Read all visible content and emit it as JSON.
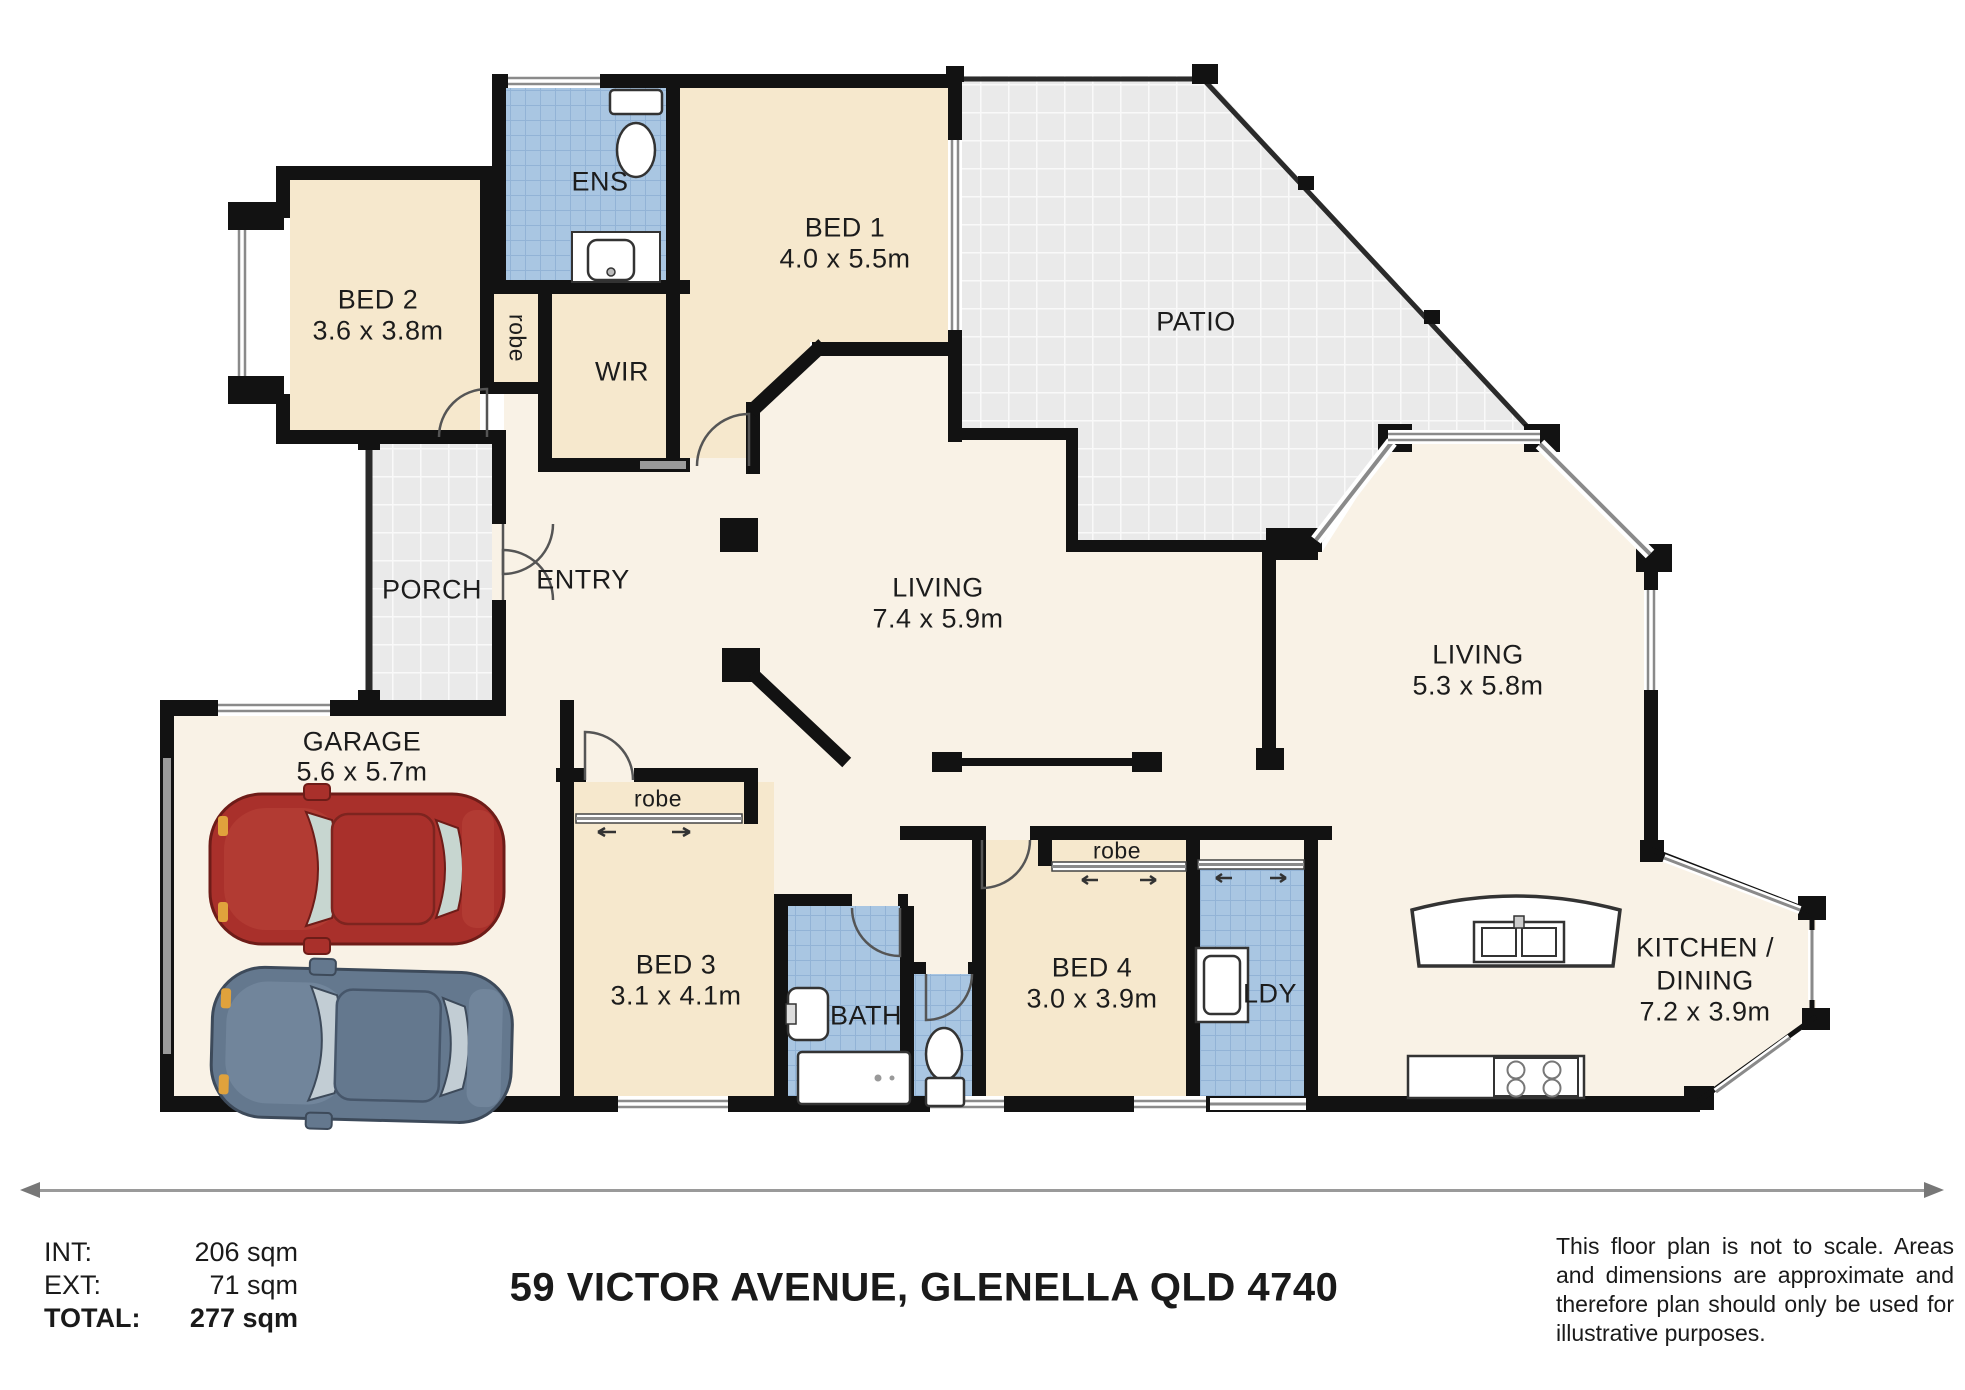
{
  "title": "59 VICTOR AVENUE, GLENELLA QLD 4740",
  "areas": {
    "int_label": "INT:",
    "int_value": "206 sqm",
    "ext_label": "EXT:",
    "ext_value": "71 sqm",
    "total_label": "TOTAL:",
    "total_value": "277 sqm"
  },
  "disclaimer": "This floor plan is not to scale. Areas and dimensions are approximate and therefore plan should only be used for illustrative purposes.",
  "rooms": {
    "ens": {
      "name": "ENS"
    },
    "bed1": {
      "name": "BED 1",
      "dims": "4.0 x 5.5m"
    },
    "bed2": {
      "name": "BED 2",
      "dims": "3.6 x 3.8m"
    },
    "robe2": {
      "name": "robe"
    },
    "wir": {
      "name": "WIR"
    },
    "patio": {
      "name": "PATIO"
    },
    "porch": {
      "name": "PORCH"
    },
    "entry": {
      "name": "ENTRY"
    },
    "living1": {
      "name": "LIVING",
      "dims": "7.4 x 5.9m"
    },
    "living2": {
      "name": "LIVING",
      "dims": "5.3 x 5.8m"
    },
    "garage": {
      "name": "GARAGE",
      "dims": "5.6 x 5.7m"
    },
    "robe3": {
      "name": "robe"
    },
    "bed3": {
      "name": "BED 3",
      "dims": "3.1 x 4.1m"
    },
    "bath": {
      "name": "BATH"
    },
    "bed4": {
      "name": "BED 4",
      "dims": "3.0 x 3.9m"
    },
    "robe4": {
      "name": "robe"
    },
    "ldy": {
      "name": "LDY"
    },
    "kitchen": {
      "line1": "KITCHEN /",
      "line2": "DINING",
      "dims": "7.2 x 3.9m"
    }
  },
  "colors": {
    "wall": "#121212",
    "room_beige": "#f6e8cd",
    "floor_cream": "#f9f2e6",
    "wet_blue": "#a9c6e2",
    "outdoor_gray": "#eaeaea",
    "car_red": "#a9302b",
    "car_blue": "#64788e"
  }
}
